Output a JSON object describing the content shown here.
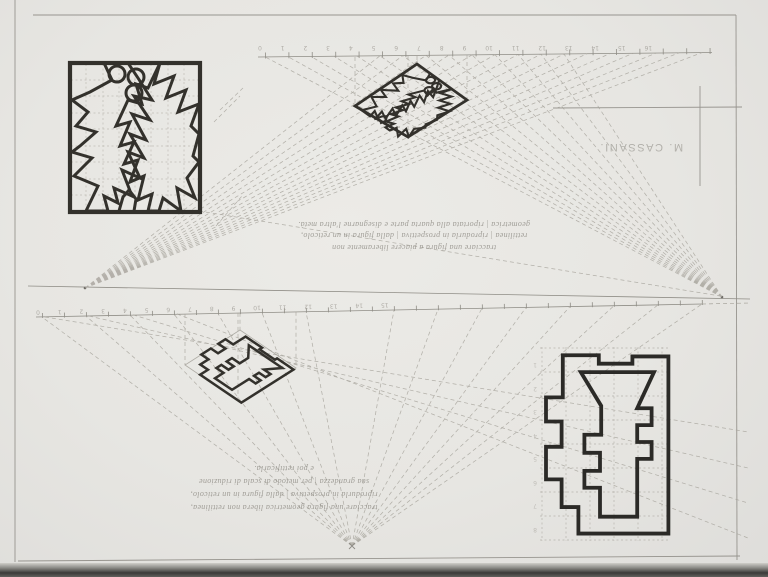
{
  "sheet": {
    "kind": "scanned pencil perspective-drawing exercise sheet (content rotated 180°)",
    "paper_color": "#e9e8e4",
    "ink_color": "#33312c",
    "pencil_color": "#8f8d86",
    "construction_line_color": "#a6a39b",
    "grid_line_color": "#c0bdb6",
    "signature": "M. CASSANI.",
    "text_orientation": "upside-down"
  },
  "top_exercise": {
    "caption_lines": [
      "tracciare una figura a piacere liberamente non",
      "rettilinea | riprodurla in prospettiva | dalla figura in un reticolo,",
      "geometrica | riportata alla quarta parte e disegnarne l'altra metà."
    ],
    "ruler": {
      "values": [
        0,
        1,
        2,
        3,
        4,
        5,
        6,
        7,
        8,
        9,
        10,
        11,
        12,
        13,
        14,
        15,
        16
      ],
      "display": "16 15 14 13 12 11 10 9 8 7 6 5 4 3 2 1 0"
    },
    "figures": [
      "gridded-star-figure-with-circles",
      "perspective-diamond-star"
    ]
  },
  "bottom_exercise": {
    "caption_lines": [
      "tracciare una figura geometrica libera non rettilinea,",
      "riprodurla in prospettiva | dalla figura in un reticolo,",
      "sua grandezza | per metodo di scala di riduzione",
      "e poi rettificarla."
    ],
    "ruler": {
      "values": [
        0,
        1,
        2,
        3,
        4,
        5,
        6,
        7,
        8,
        9,
        10,
        11,
        12,
        13,
        14,
        15
      ],
      "display": "15 14 13 12 11 10 9 8 7 6 5 4 3 2 1 0"
    },
    "grid_row_numbers": "8\n7\n6\n5\n4\n3\n2\n1",
    "figures": [
      "perspective-diamond-castle",
      "gridded-castle-figure"
    ]
  }
}
